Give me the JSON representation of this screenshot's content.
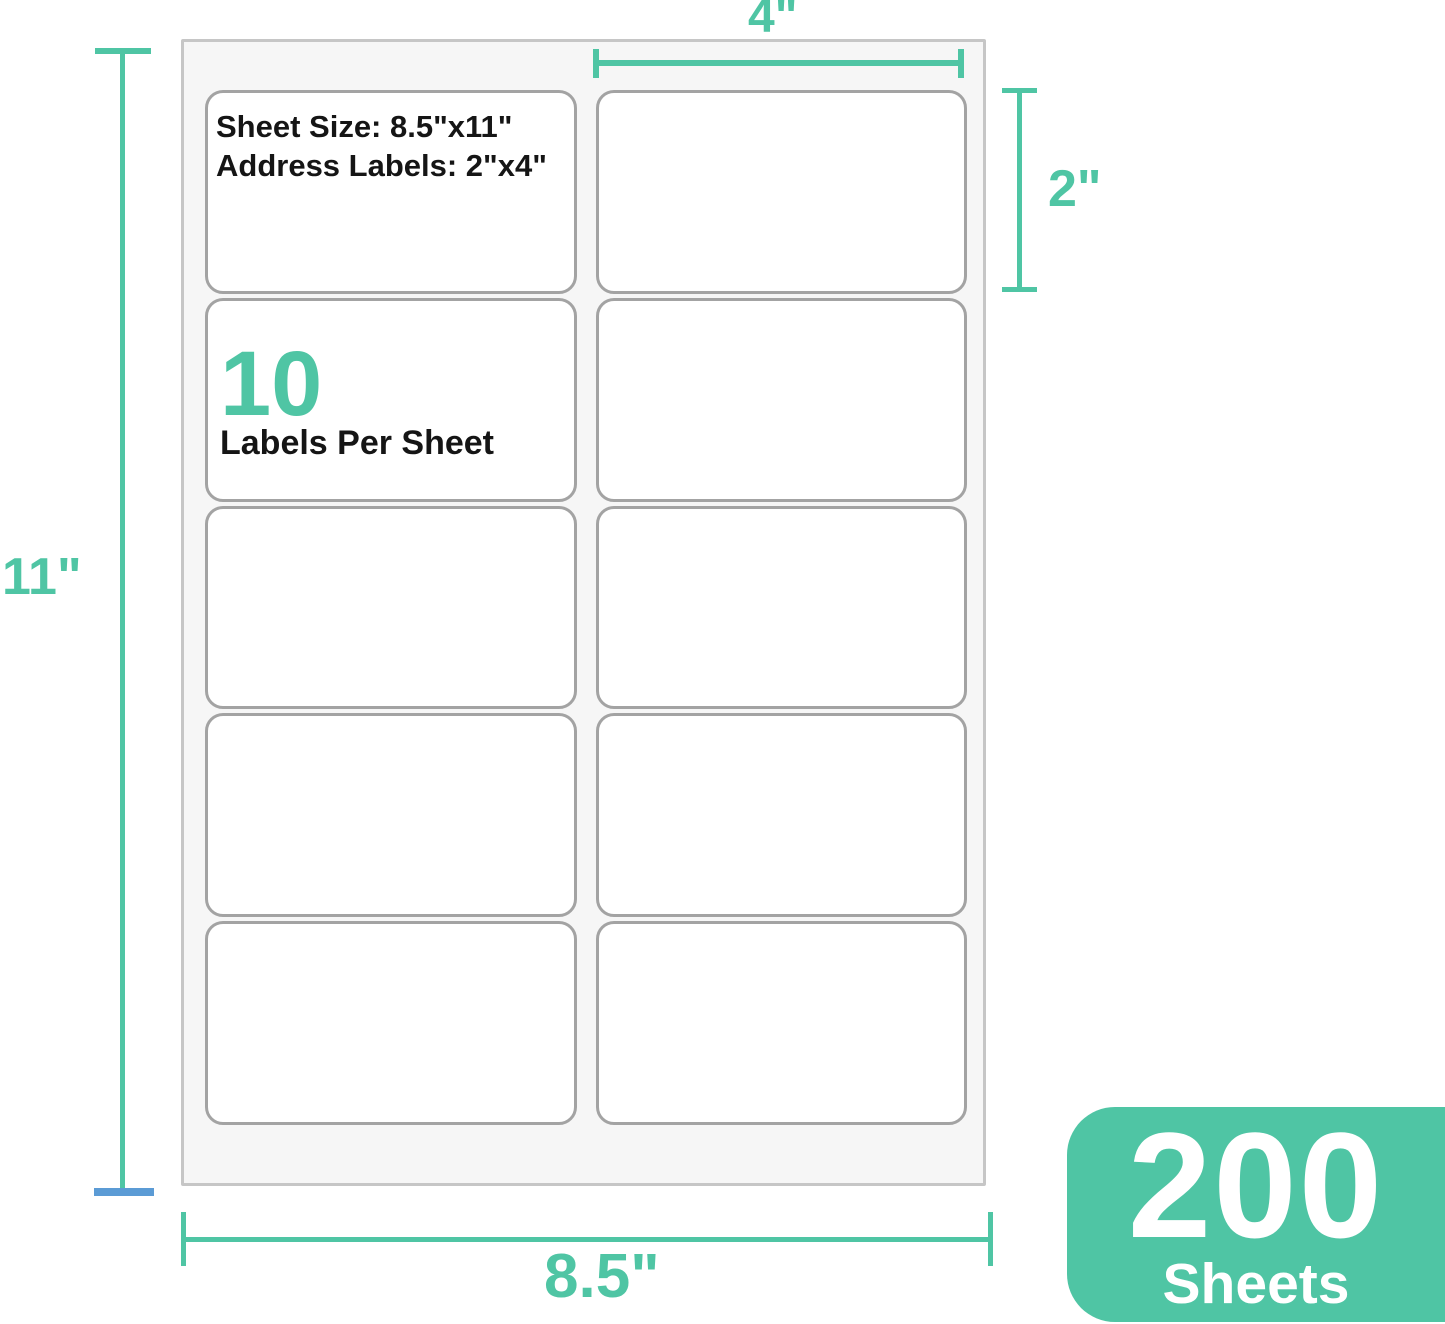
{
  "colors": {
    "accent": "#4fc5a4",
    "blue_cap": "#5b9bd5",
    "label_border": "#a3a3a3",
    "sheet_border": "#c6c6c6",
    "sheet_bg": "#f6f6f6",
    "text": "#151515"
  },
  "sheet": {
    "info_line1": "Sheet Size: 8.5\"x11\"",
    "info_line2": "Address Labels: 2\"x4\"",
    "count_number": "10",
    "count_caption": "Labels Per Sheet",
    "rows": 5,
    "cols": 2
  },
  "dims": {
    "top": "4\"",
    "right": "2\"",
    "left": "11\"",
    "bottom": "8.5\""
  },
  "badge": {
    "number": "200",
    "caption": "Sheets"
  }
}
